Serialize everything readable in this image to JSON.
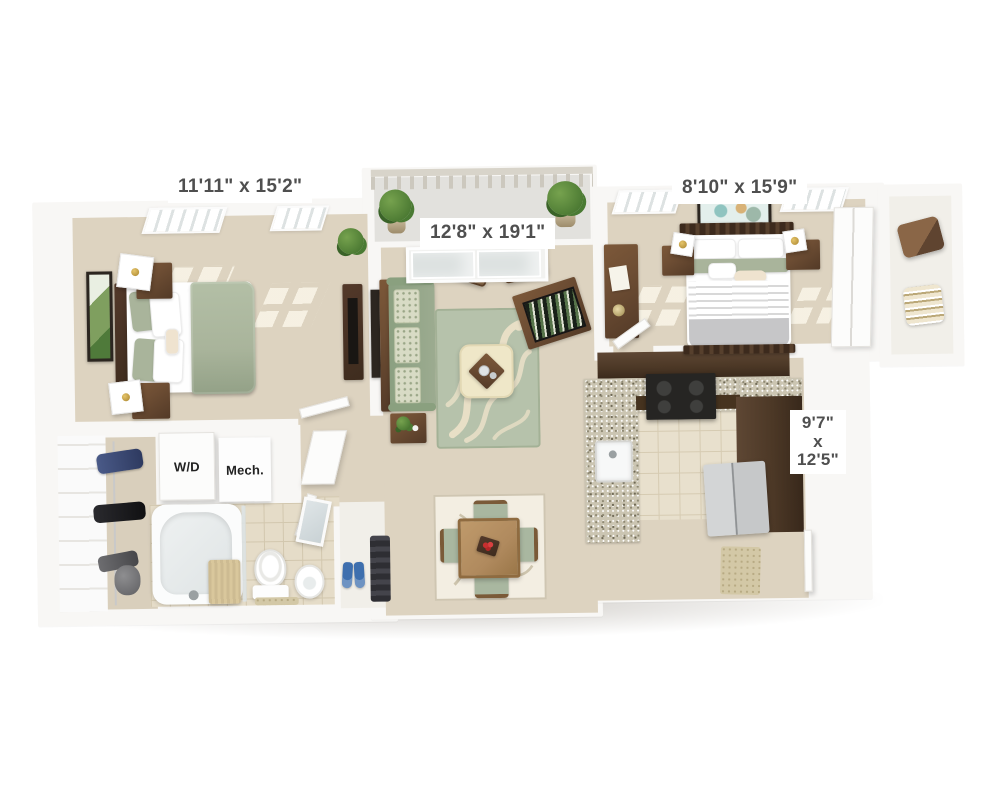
{
  "plan_type": "3d-apartment-floor-plan",
  "rooms": {
    "bedroom_left": {
      "dimensions": "11'11\" x 15'2\""
    },
    "living_room": {
      "dimensions": "12'8\" x 19'1\""
    },
    "bedroom_right": {
      "dimensions": "8'10\" x 15'9\""
    },
    "kitchen": {
      "dim_line1": "9'7\"",
      "dim_line2": "x",
      "dim_line3": "12'5\""
    },
    "laundry_closet": {
      "label": "W/D"
    },
    "mechanical_closet": {
      "label": "Mech."
    }
  },
  "colors": {
    "wall": "#f8f7f5",
    "carpet": "#ddd3c0",
    "tile": "#e8e0cd",
    "tile-line": "#d6cbb2",
    "bath-tile": "#e5dcc8",
    "balcony-floor": "#e2e1dd",
    "sofa": "#9cab90",
    "sage": "#a9b49b",
    "rug": "#b6c2ab",
    "rug-pattern": "#e8dfc6",
    "wood": "#6e4e34",
    "dark-wood": "#3e2c1e",
    "cabinet": "#4c3826",
    "counter": "#cbc5b2",
    "stainless": "#c6c8c9",
    "stove": "#262523",
    "ottoman": "#efe7c8",
    "gray-bed": "#c6c6c8",
    "curtain": "#d9c79c",
    "slipper": "#3e6fae",
    "plant": "#4c7a33",
    "mat": "#d3c8a6",
    "dining-table": "#b08a5e",
    "chair-sage": "#a9b7a0",
    "label-bg": "#ffffff",
    "label-text": "#4f4f4f"
  }
}
